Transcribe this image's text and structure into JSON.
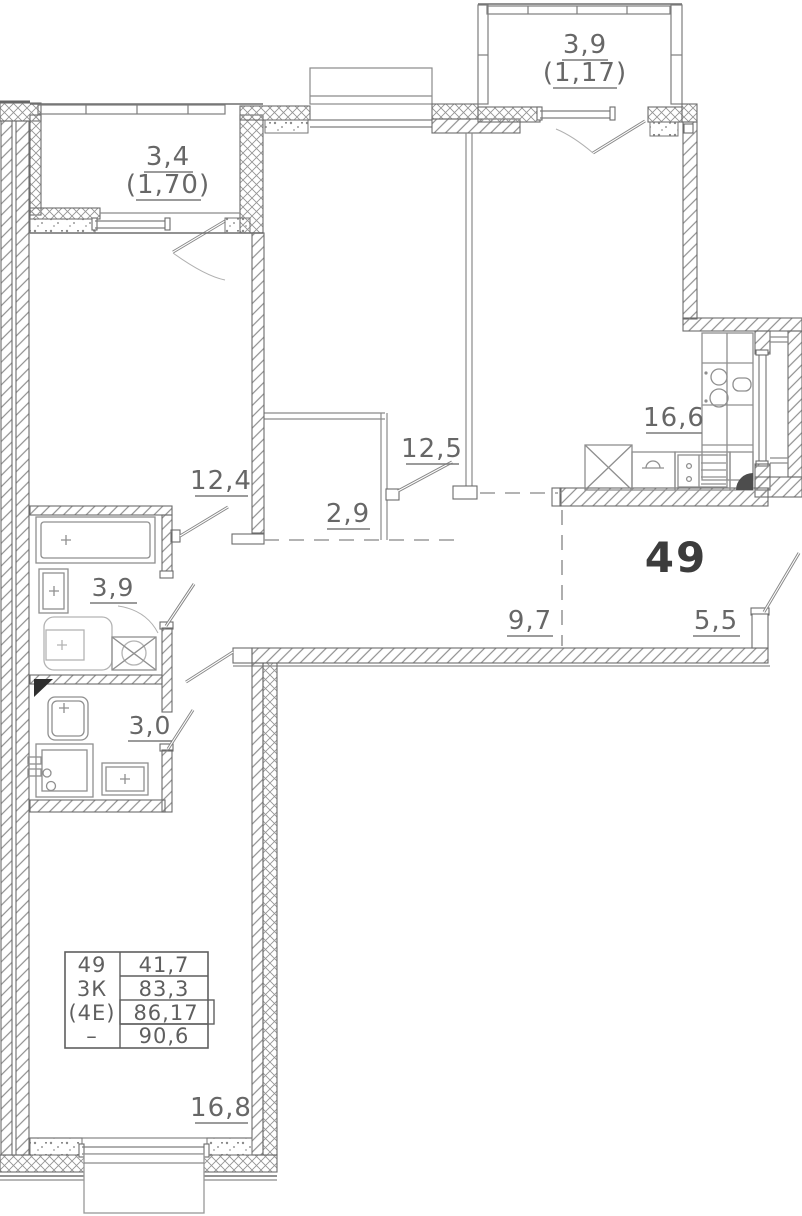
{
  "apartment": {
    "number": "49"
  },
  "labels": {
    "balcony_tl": {
      "area": "3,4",
      "reduced": "(1,70)"
    },
    "balcony_tr": {
      "area": "3,9",
      "reduced": "(1,17)"
    },
    "room_12_4": "12,4",
    "room_12_5": "12,5",
    "wardrobe": "2,9",
    "kitchen_living": "16,6",
    "hallway": "9,7",
    "entry": "5,5",
    "bathroom": "3,9",
    "wc": "3,0",
    "bedroom": "16,8"
  },
  "info_table": {
    "rows": [
      {
        "left": "49",
        "right": "41,7"
      },
      {
        "left": "3К",
        "right": "83,3"
      },
      {
        "left": "(4Е)",
        "right": "86,17"
      },
      {
        "left": "–",
        "right": "90,6"
      }
    ]
  },
  "colors": {
    "wall_line": "#6b6b6b",
    "label": "#676767",
    "big_label": "#3c3c3c"
  }
}
